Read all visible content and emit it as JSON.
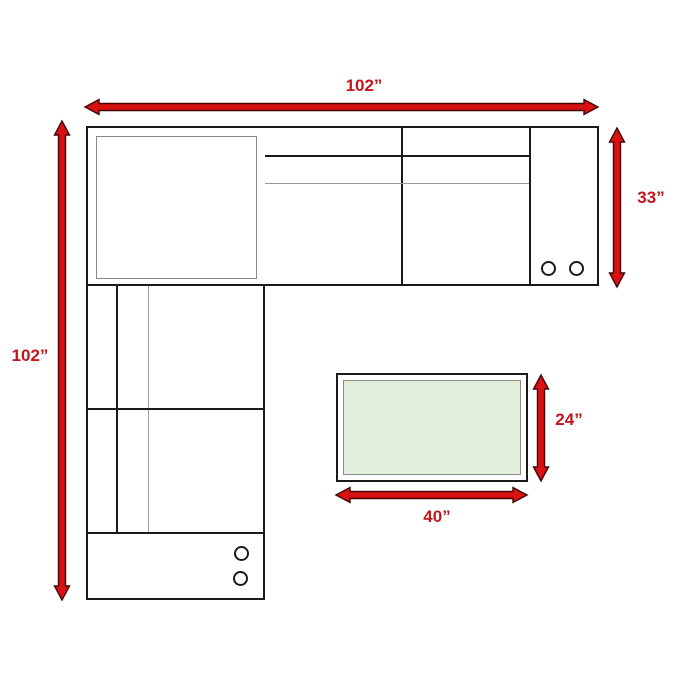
{
  "diagram": {
    "type": "furniture-dimension-floorplan",
    "subject": "L-shaped sectional sofa with ottoman, top view with dimension arrows",
    "labels": {
      "overall_width": "102”",
      "overall_depth": "102”",
      "sofa_depth": "33”",
      "ottoman_depth": "24”",
      "ottoman_width": "40”"
    },
    "colors": {
      "arrow_fill": "#d91111",
      "arrow_outline": "#420606",
      "label_text": "#c3161c",
      "sofa_outline": "#1a1a1a",
      "thin_line": "#9a9a9a",
      "ottoman_fill": "#e2efda",
      "page_bg": "#ffffff"
    },
    "features": {
      "right_console_cupholders": 2,
      "bottom_console_cupholders": 2
    }
  }
}
